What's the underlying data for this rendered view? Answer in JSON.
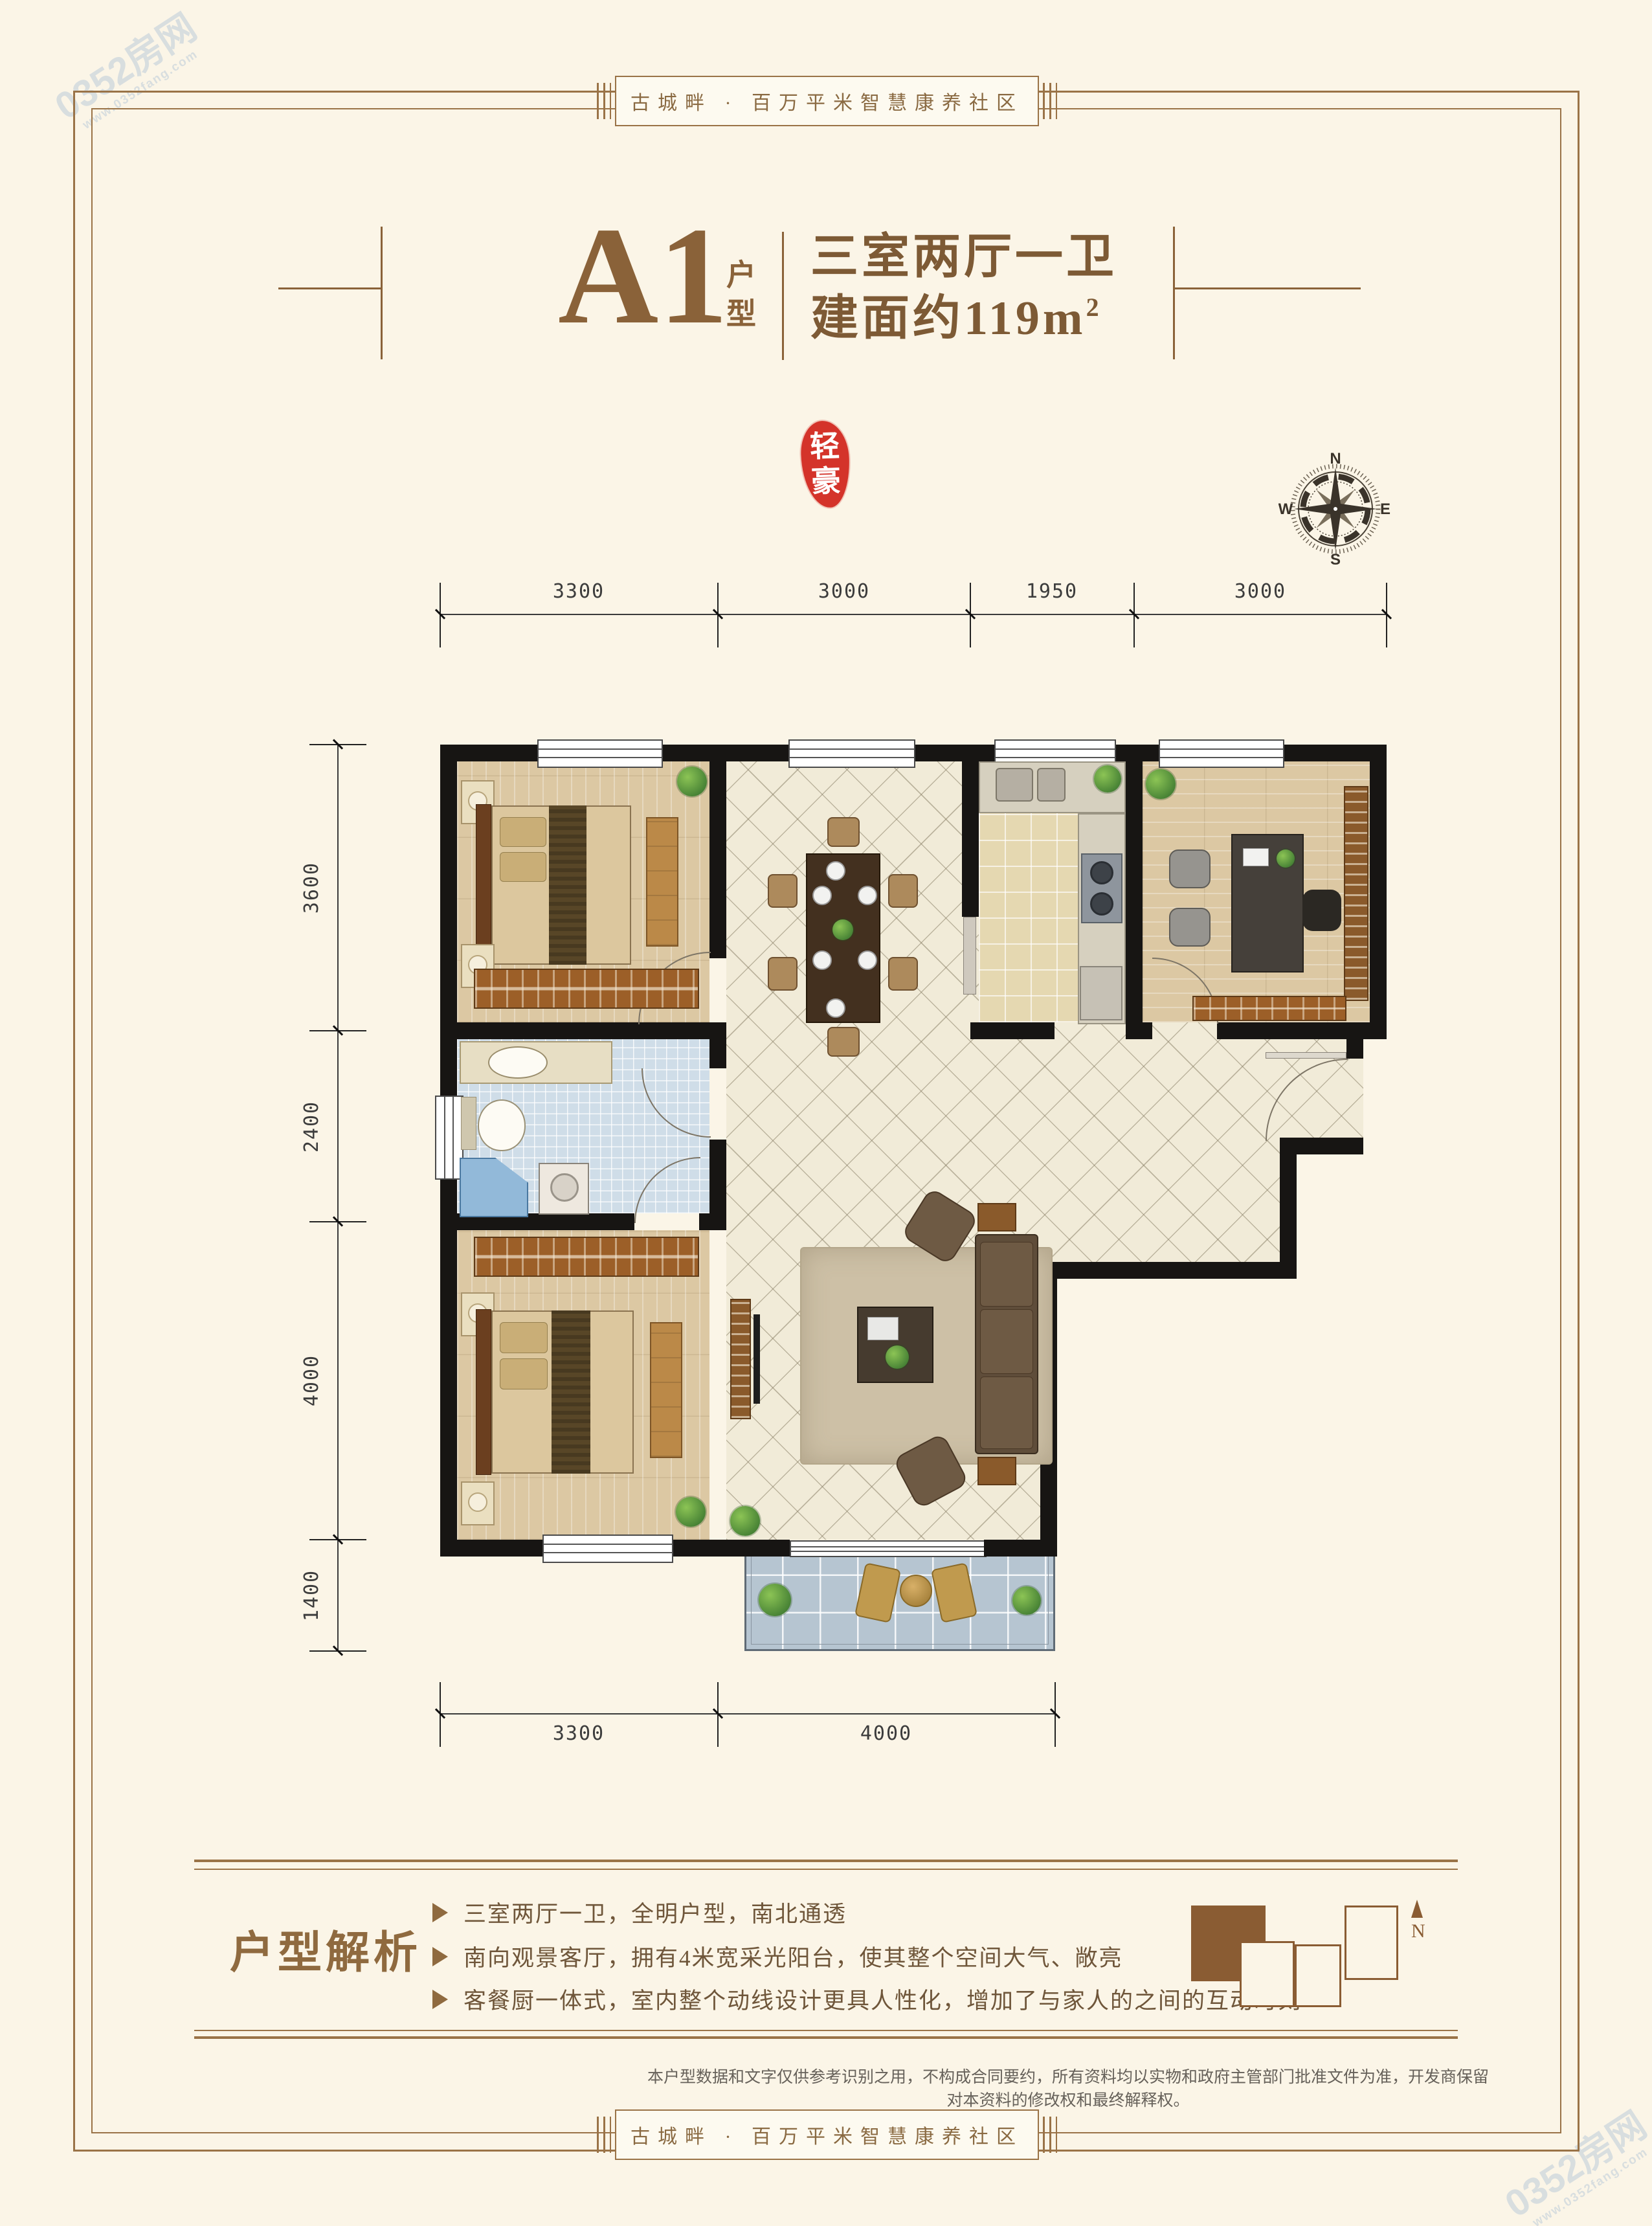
{
  "banner": {
    "text": "古城畔 · 百万平米智慧康养社区"
  },
  "title": {
    "unit": "A1",
    "unit_type": "户型",
    "rooms": "三室两厅一卫",
    "area": "建面约119m",
    "area_sup": "2"
  },
  "seal": {
    "char1": "轻",
    "char2": "豪"
  },
  "compass": {
    "n": "N",
    "e": "E",
    "s": "S",
    "w": "W"
  },
  "dimensions": {
    "top": [
      "3300",
      "3000",
      "1950",
      "3000"
    ],
    "left": [
      "3600",
      "2400",
      "4000",
      "1400"
    ],
    "bottom": [
      "3300",
      "4000"
    ]
  },
  "analysis": {
    "title": "户型解析",
    "bullets": [
      "三室两厅一卫，全明户型，南北通透",
      "南向观景客厅，拥有4米宽采光阳台，使其整个空间大气、敞亮",
      "客餐厨一体式，室内整个动线设计更具人性化，增加了与家人的之间的互动时刻"
    ]
  },
  "keyplan": {
    "north": "N"
  },
  "disclaimer": {
    "text": "本户型数据和文字仅供参考识别之用，不构成合同要约，所有资料均以实物和政府主管部门批准文件为准，开发商保留对本资料的修改权和最终解释权。"
  },
  "watermark": {
    "name": "0352房网",
    "url": "www.0352fang.com"
  },
  "colors": {
    "frame": "#9a7347",
    "title_brown": "#8a6239",
    "seal_red": "#d4332a",
    "wall": "#171513",
    "text_brown": "#6f563a"
  }
}
